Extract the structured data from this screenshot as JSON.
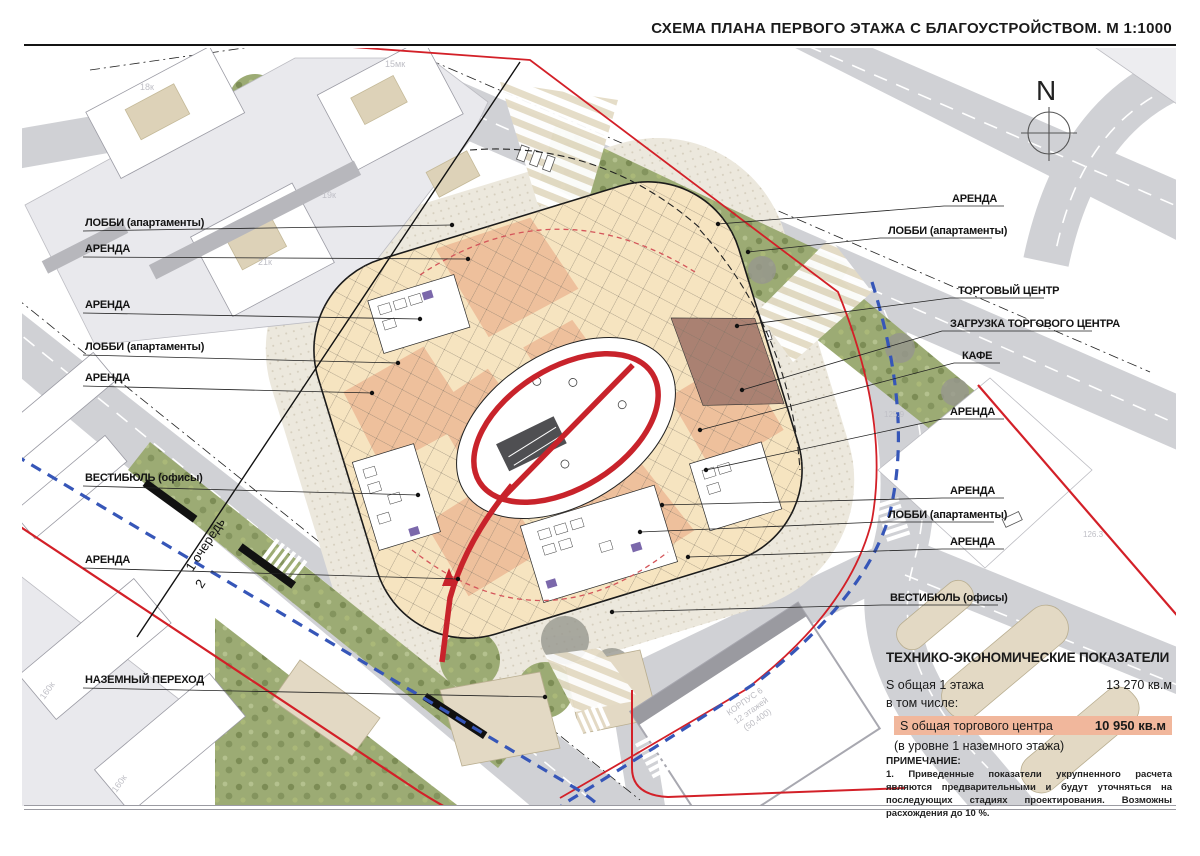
{
  "title": "СХЕМА ПЛАНА ПЕРВОГО ЭТАЖА С БЛАГОУСТРОЙСТВОМ. М 1:1000",
  "compass": {
    "north_label": "N"
  },
  "phase": {
    "label_primary": "1 очередь",
    "label_secondary": "2"
  },
  "labels_left": [
    {
      "text": "ЛОББИ (апартаменты)"
    },
    {
      "text": "АРЕНДА"
    },
    {
      "text": "АРЕНДА"
    },
    {
      "text": "ЛОББИ (апартаменты)"
    },
    {
      "text": "АРЕНДА"
    },
    {
      "text": "ВЕСТИБЮЛЬ (офисы)"
    },
    {
      "text": "АРЕНДА"
    },
    {
      "text": "НАЗЕМНЫЙ ПЕРЕХОД"
    }
  ],
  "labels_right": [
    {
      "text": "АРЕНДА"
    },
    {
      "text": "ЛОББИ (апартаменты)"
    },
    {
      "text": "ТОРГОВЫЙ ЦЕНТР"
    },
    {
      "text": "ЗАГРУЗКА ТОРГОВОГО ЦЕНТРА"
    },
    {
      "text": "КАФЕ"
    },
    {
      "text": "АРЕНДА"
    },
    {
      "text": "АРЕНДА"
    },
    {
      "text": "ЛОББИ (апартаменты)"
    },
    {
      "text": "АРЕНДА"
    },
    {
      "text": "ВЕСТИБЮЛЬ (офисы)"
    }
  ],
  "map_texts": {
    "b18k": "18к",
    "b15mk": "15мк",
    "b19k": "19к",
    "b21k": "21к",
    "b160k_a": "160к",
    "b160k_b": "160к",
    "korpus6_l1": "КОРПУС 6",
    "korpus6_l2": "12 этажей",
    "korpus6_l3": "(50,400)",
    "elev_a": "125.9",
    "elev_b": "126.3"
  },
  "tep": {
    "heading": "ТЕХНИКО-ЭКОНОМИЧЕСКИЕ ПОКАЗАТЕЛИ",
    "row1_label": "S общая 1 этажа",
    "row1_value": "13 270 кв.м",
    "subnote": "в том числе:",
    "highlight_label": "S общая торгового центра",
    "highlight_value": "10 950 кв.м",
    "highlight_note": "(в уровне 1 наземного этажа)",
    "note_heading": "ПРИМЕЧАНИЕ:",
    "note_text": "1. Приведенные показатели укрупненного расчета являются предварительными и будут уточняться на последующих стадиях проектирования. Возможны расхождения до 10 %."
  },
  "colors": {
    "building_cream": "#f6e4c0",
    "building_salmon": "#eec09c",
    "loading_brown": "#aa8172",
    "circulation_red": "#c8232b",
    "boundary_blue": "#3656b8",
    "highlight_bg": "#f1b79c",
    "road_gray": "#d0d1d5",
    "green": "#9cab74"
  }
}
